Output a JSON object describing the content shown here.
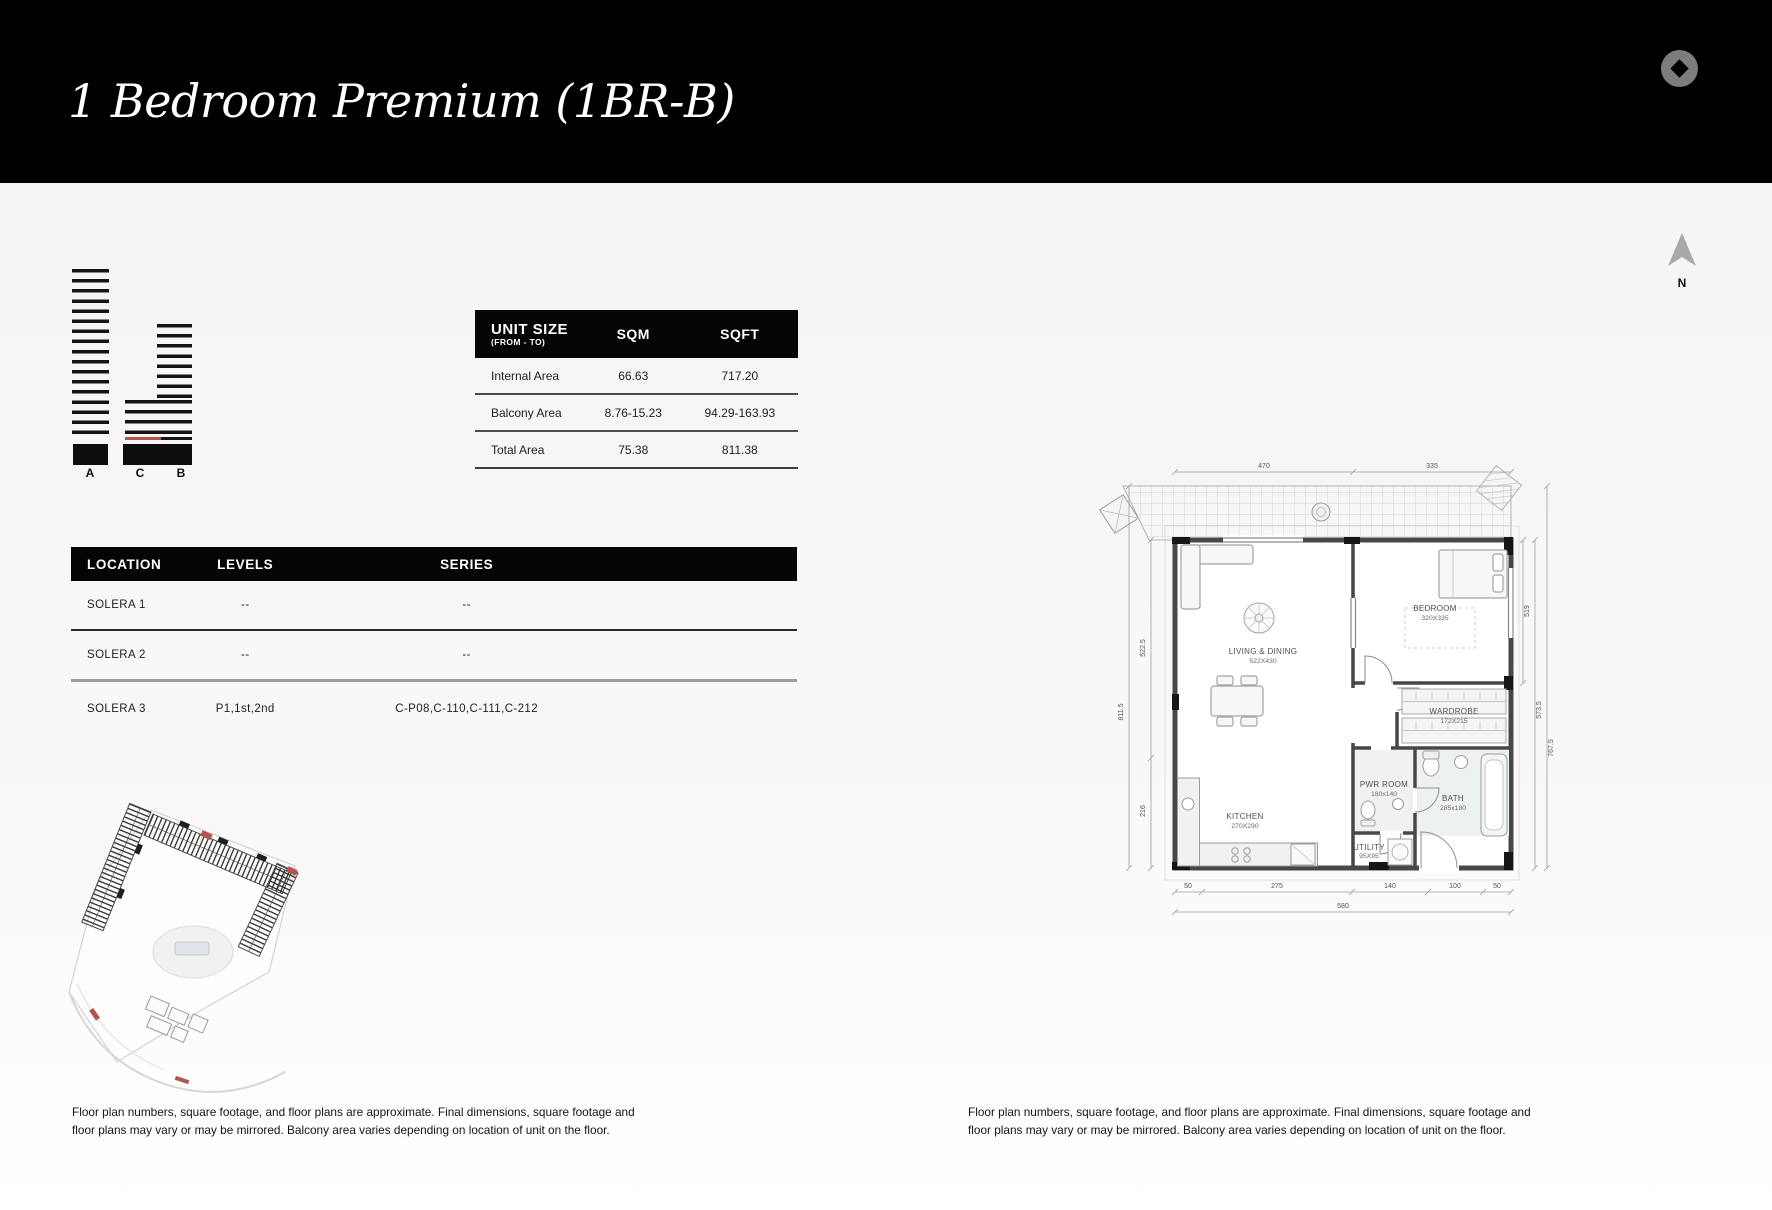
{
  "header": {
    "title": "1 Bedroom Premium (1BR-B)"
  },
  "compass": {
    "label": "N"
  },
  "elevation": {
    "labels": [
      "A",
      "C",
      "B"
    ],
    "highlight_color": "#b5544c"
  },
  "unit_size_table": {
    "col_unit": "UNIT SIZE",
    "col_unit_sub": "(FROM - TO)",
    "col_sqm": "SQM",
    "col_sqft": "SQFT",
    "rows": [
      {
        "label": "Internal Area",
        "sqm": "66.63",
        "sqft": "717.20"
      },
      {
        "label": "Balcony Area",
        "sqm": "8.76-15.23",
        "sqft": "94.29-163.93"
      },
      {
        "label": "Total Area",
        "sqm": "75.38",
        "sqft": "811.38"
      }
    ]
  },
  "location_table": {
    "col_location": "LOCATION",
    "col_levels": "LEVELS",
    "col_series": "SERIES",
    "rows": [
      {
        "location": "SOLERA 1",
        "levels": "--",
        "series": "--"
      },
      {
        "location": "SOLERA 2",
        "levels": "--",
        "series": "--"
      },
      {
        "location": "SOLERA 3",
        "levels": "P1,1st,2nd",
        "series": "C-P08,C-110,C-111,C-212"
      }
    ]
  },
  "floor_plan": {
    "rooms": [
      {
        "name": "LIVING & DINING",
        "size": "522X430"
      },
      {
        "name": "BEDROOM",
        "size": "320X335"
      },
      {
        "name": "WARDROBE",
        "size": "172X215"
      },
      {
        "name": "PWR ROOM",
        "size": "180x140"
      },
      {
        "name": "BATH",
        "size": "285x180"
      },
      {
        "name": "KITCHEN",
        "size": "270X290"
      },
      {
        "name": "UTILITY",
        "size": "95X95"
      }
    ],
    "dims": {
      "left": [
        "522.5",
        "811.5",
        "216"
      ],
      "right": [
        "519",
        "573.5",
        "767.5"
      ],
      "top": [
        "470",
        "335"
      ],
      "bottom": [
        "50",
        "275",
        "140",
        "100",
        "50"
      ],
      "bottom_total": "580"
    }
  },
  "disclaimer": "Floor plan numbers, square footage, and floor plans are approximate. Final dimensions, square footage and floor plans may vary or may be mirrored. Balcony area varies depending on location of unit on the floor."
}
